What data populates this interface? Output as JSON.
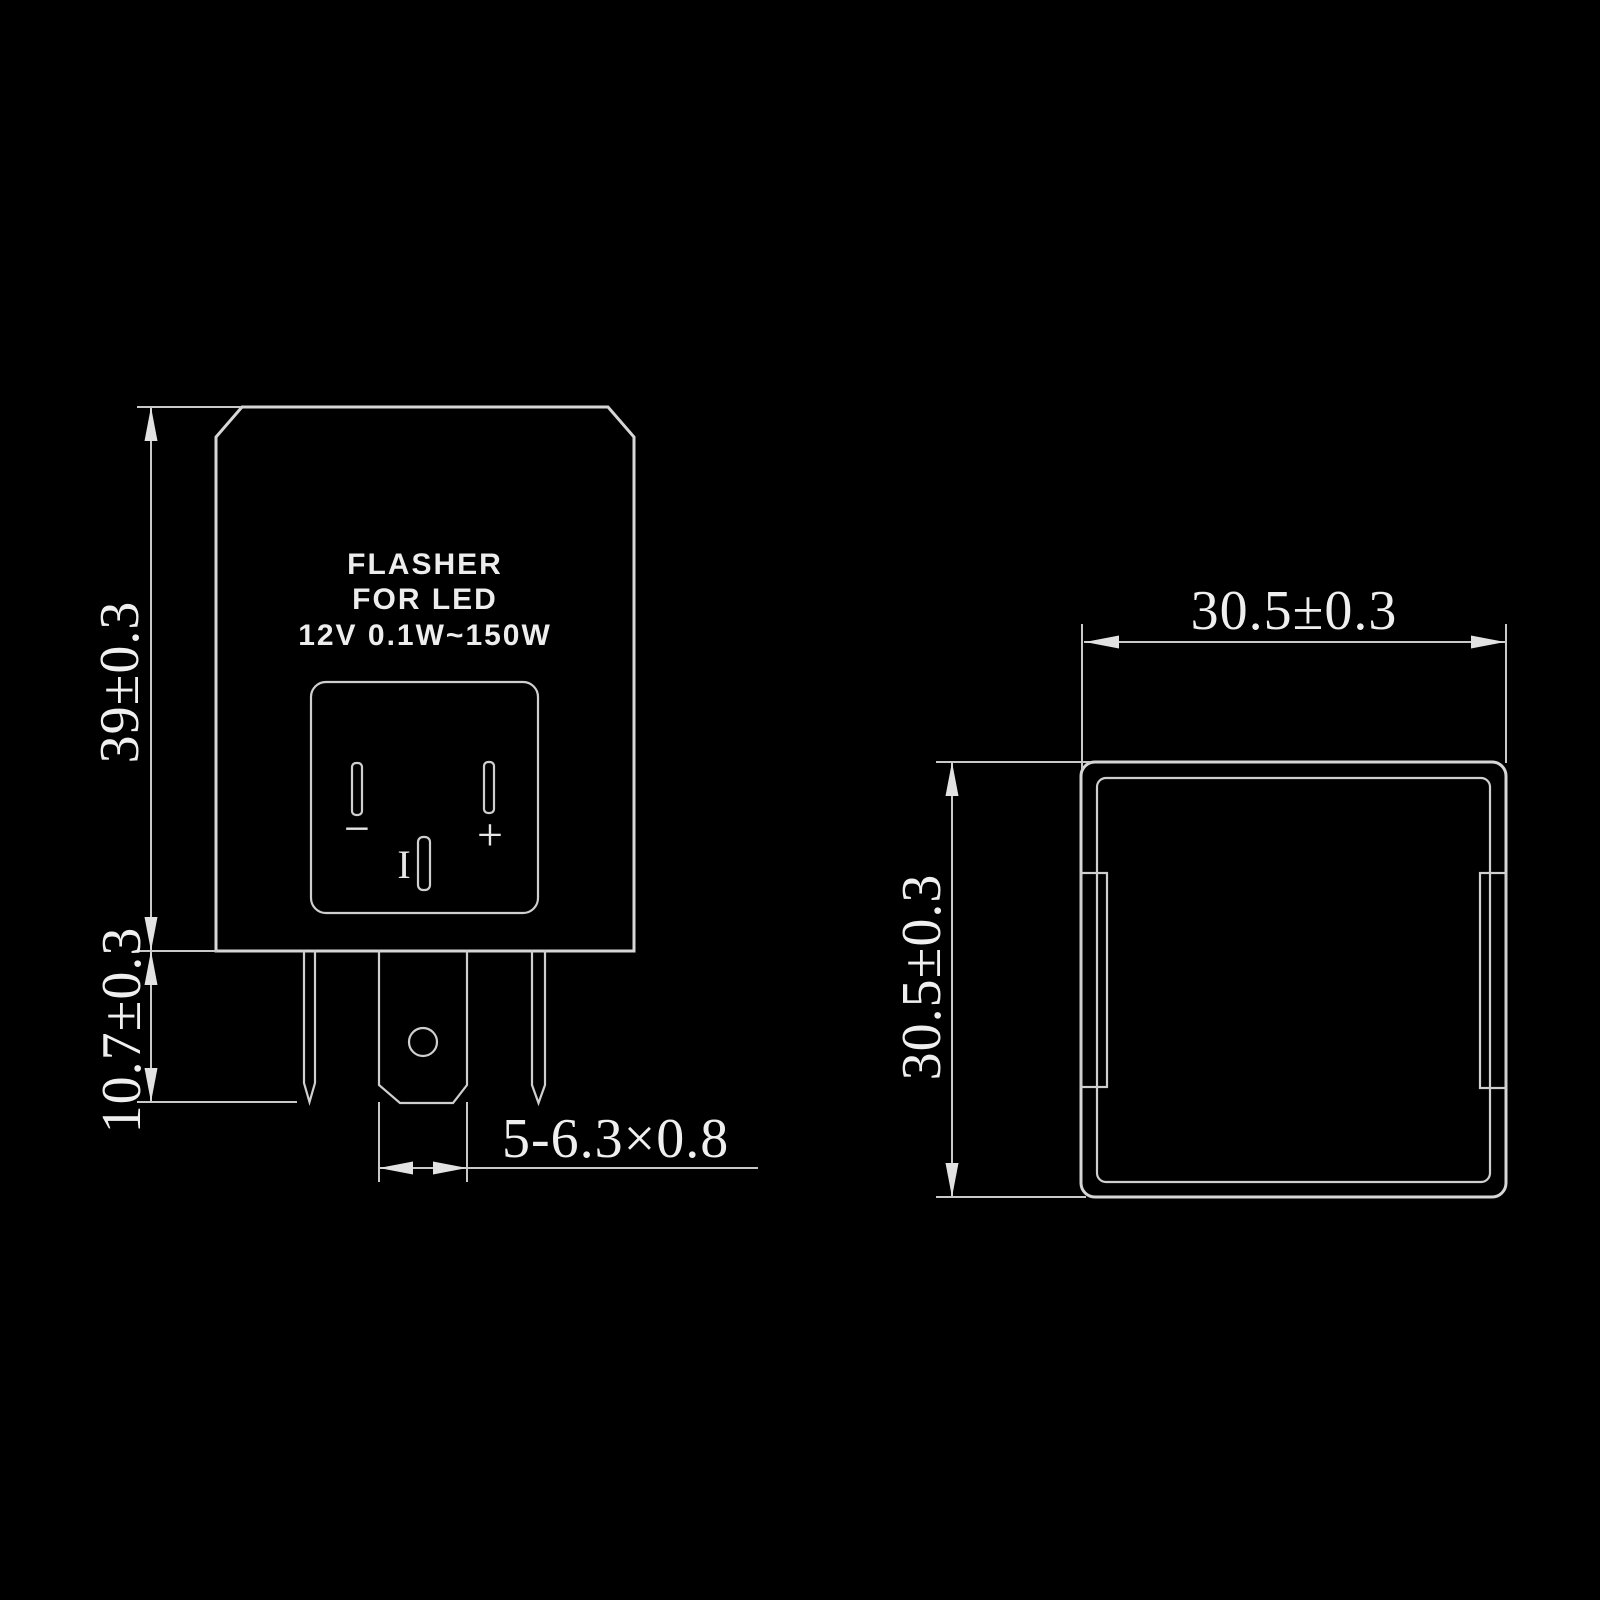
{
  "drawing_title": "LED flasher relay dimension drawing",
  "front_view": {
    "product_label": {
      "line1": "FLASHER",
      "line2": "FOR LED",
      "line3": "12V 0.1W~150W"
    },
    "terminals": {
      "negative_symbol": "−",
      "positive_symbol": "+",
      "load_symbol": "I"
    },
    "dimensions": {
      "body_height_mm": "39±0.3",
      "pin_length_mm": "10.7±0.3",
      "blade_terminal_spec": "5-6.3×0.8"
    }
  },
  "side_view": {
    "dimensions": {
      "width_mm": "30.5±0.3",
      "height_mm": "30.5±0.3"
    }
  },
  "colors": {
    "background": "#000000",
    "line": "#d6d6d6",
    "dimension_line": "#c9c9c9",
    "text": "#efefef"
  }
}
